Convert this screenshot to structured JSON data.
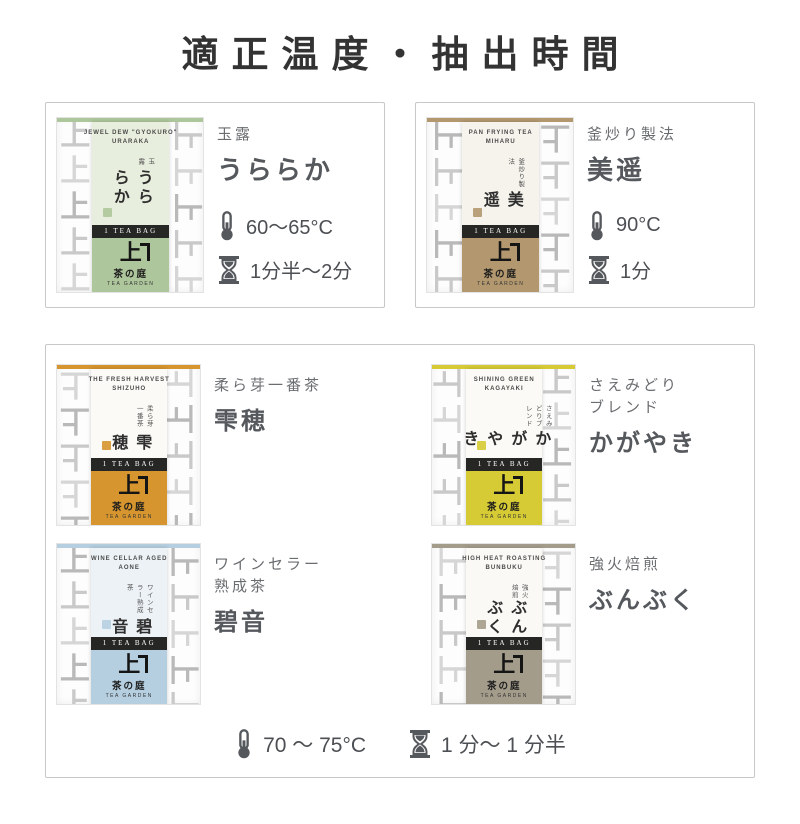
{
  "title": "適正温度・抽出時間",
  "brand": {
    "logo": "上",
    "name": "茶の庭",
    "sub": "TEA GARDEN",
    "teabag": "1 TEA BAG"
  },
  "shared": {
    "temp": "70 〜 75°C",
    "time": "1 分〜 1 分半"
  },
  "colors": {
    "card_border": "#c8c8c8",
    "pattern_gray": "#c9c9c9",
    "icon_gray": "#55585c",
    "teabag_band": "#262624"
  },
  "products": [
    {
      "en1": "JEWEL DEW \"GYOKURO\"",
      "en2": "URARAKA",
      "vertical_sub": "玉露",
      "name_ja": "うららか",
      "category": "玉露",
      "category2": "",
      "display_name": "うららか",
      "temp": "60〜65°C",
      "time": "1分半〜2分",
      "accent": "#aec69b",
      "panel": "#e8eedd"
    },
    {
      "en1": "PAN FRYING TEA",
      "en2": "MIHARU",
      "vertical_sub": "釜炒り製法",
      "name_ja": "美遥",
      "category": "釜炒り製法",
      "category2": "",
      "display_name": "美遥",
      "temp": "90°C",
      "time": "1分",
      "accent": "#b3986f",
      "panel": "#f6f3ec"
    },
    {
      "en1": "THE FRESH HARVEST",
      "en2": "SHIZUHO",
      "vertical_sub": "柔ら芽一番茶",
      "name_ja": "雫穂",
      "category": "柔ら芽一番茶",
      "category2": "",
      "display_name": "雫穂",
      "accent": "#d6952e",
      "panel": "#fbfaf6"
    },
    {
      "en1": "SHINING GREEN",
      "en2": "KAGAYAKI",
      "vertical_sub": "さえみどりブレンド",
      "name_ja": "かがやき",
      "category": "さえみどり",
      "category2": "ブレンド",
      "display_name": "かがやき",
      "accent": "#d6cb35",
      "panel": "#fbfaf6"
    },
    {
      "en1": "WINE CELLAR AGED",
      "en2": "AONE",
      "vertical_sub": "ワインセラー熟成茶",
      "name_ja": "碧音",
      "category": "ワインセラー",
      "category2": "熟成茶",
      "display_name": "碧音",
      "accent": "#b5cfe0",
      "panel": "#edf2f6"
    },
    {
      "en1": "HIGH HEAT ROASTING",
      "en2": "BUNBUKU",
      "vertical_sub": "強火焙煎",
      "name_ja": "ぶんぶく",
      "category": "強火焙煎",
      "category2": "",
      "display_name": "ぶんぶく",
      "accent": "#a49c8b",
      "panel": "#faf9f5"
    }
  ]
}
